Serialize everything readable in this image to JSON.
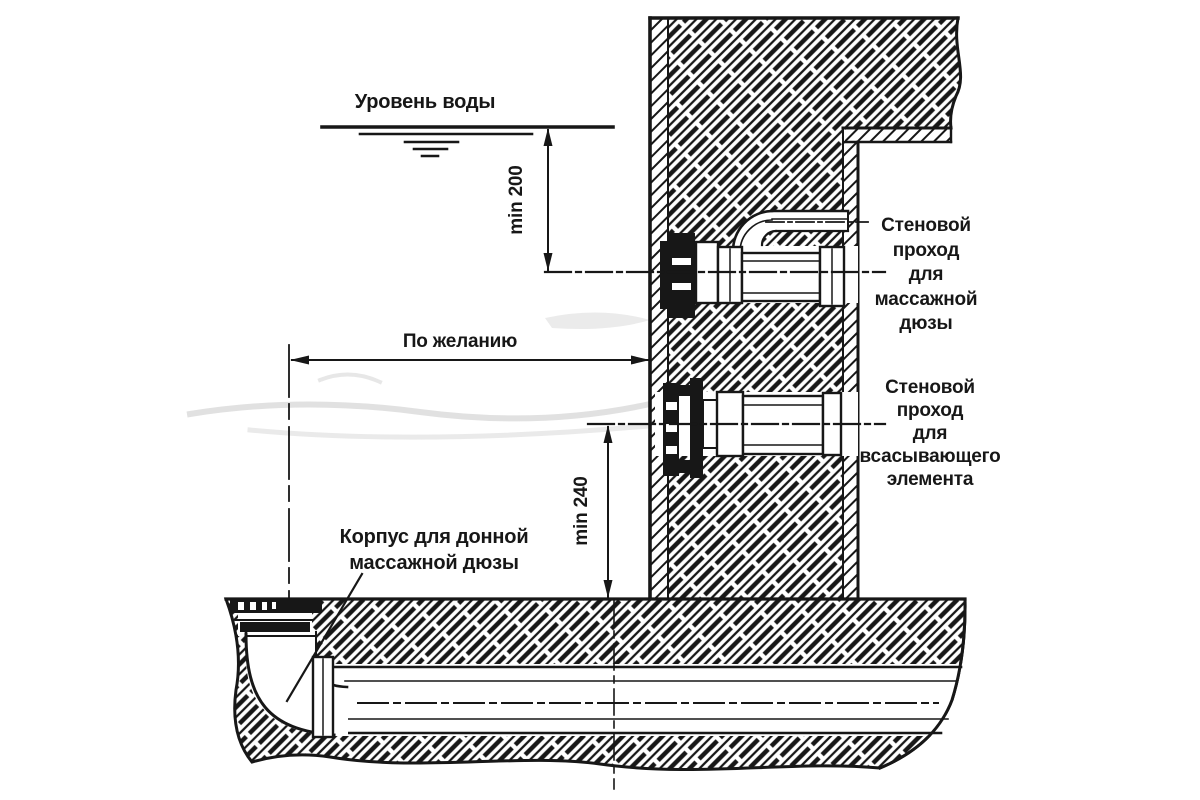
{
  "diagram": {
    "title_hint": "Pool wall cross-section: installation of massage nozzle wall passages",
    "labels": {
      "water_level": "Уровень воды",
      "dim_min200": "min 200",
      "dim_optional": "По желанию",
      "dim_min240": "min 240",
      "wall_pass_massage": "Стеновой\nпроход\nдля\nмассажной\nдюзы",
      "wall_pass_suction": "Стеновой\nпроход\nдля\nвсасывающего\nэлемента",
      "bottom_nozzle_housing": "Корпус для донной\nмассажной дюзы"
    },
    "colors": {
      "ink": "#171717",
      "paper": "#ffffff",
      "artifact_gray": "#dcdcdc"
    }
  }
}
